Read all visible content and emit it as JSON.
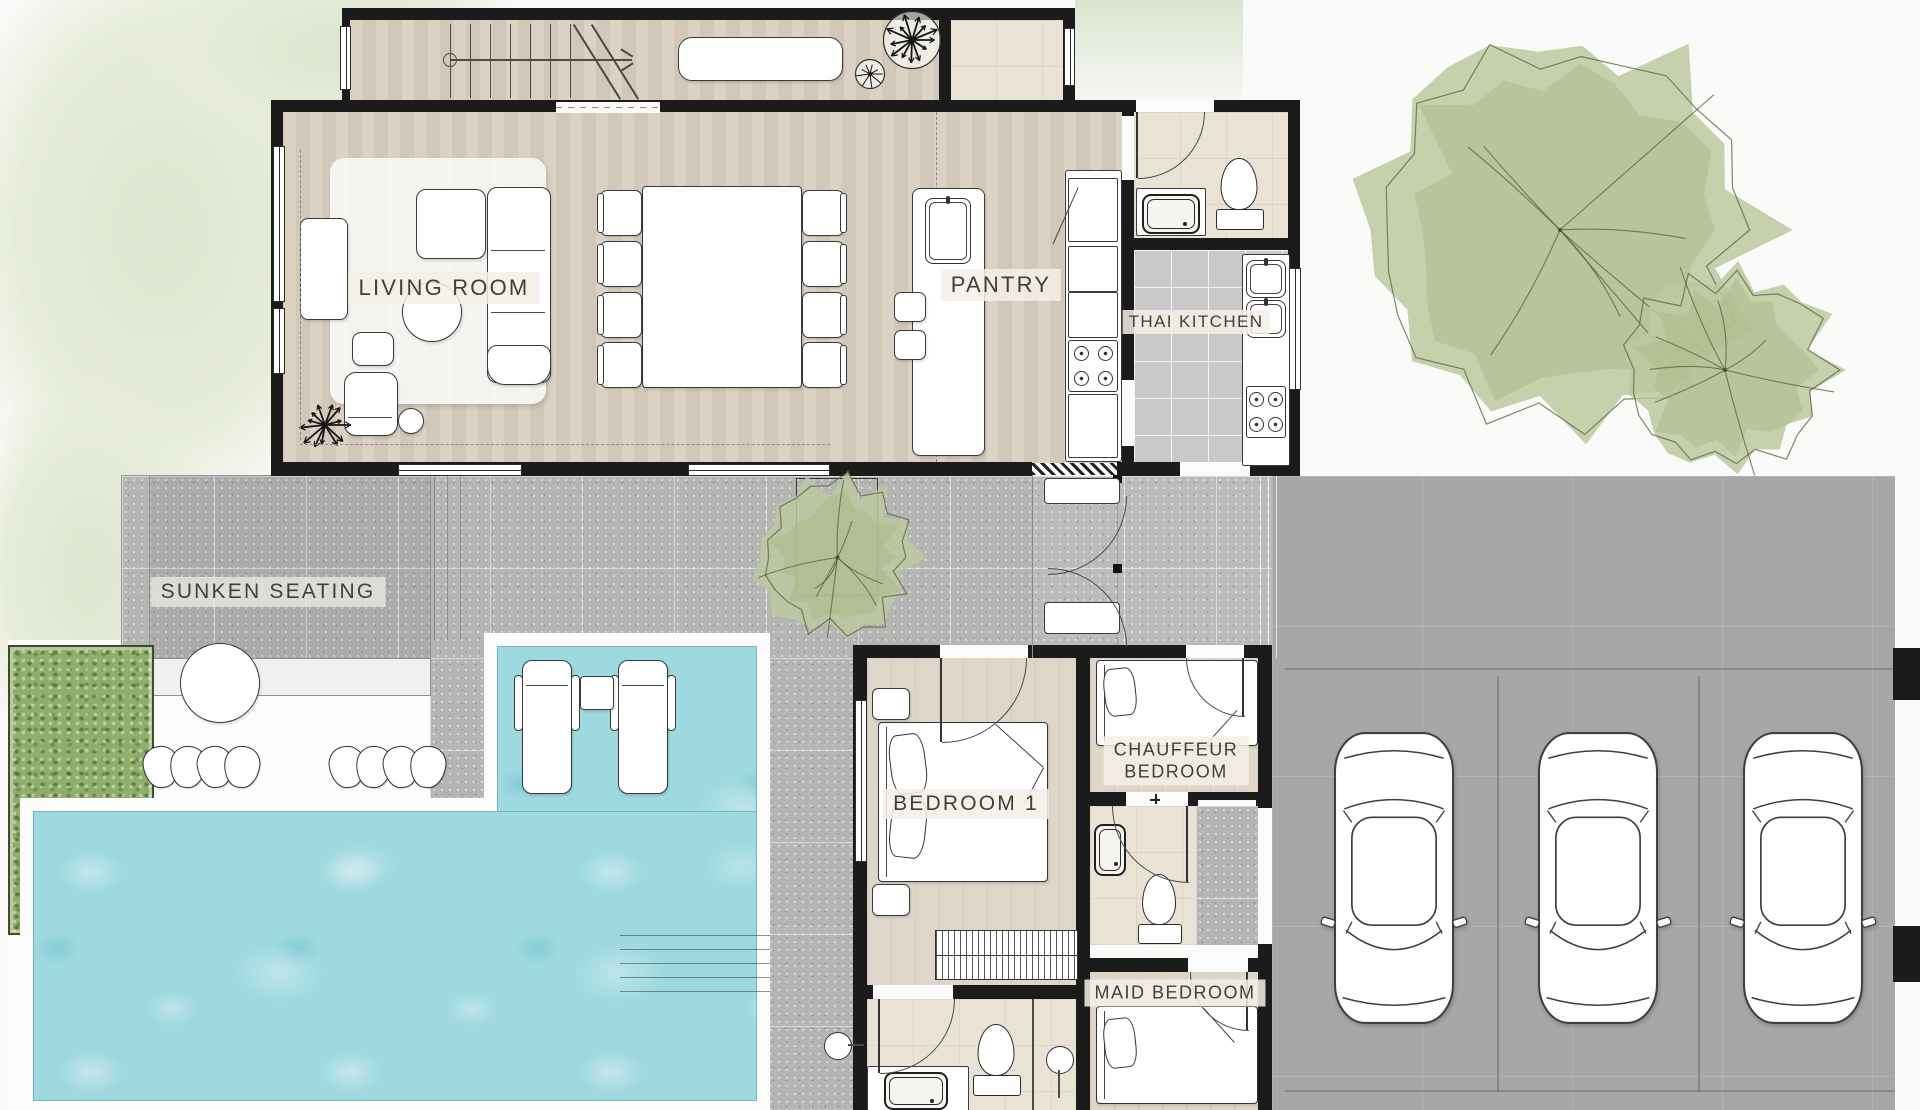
{
  "meta": {
    "type": "architectural floor plan",
    "view": "top-down villa ground floor with pool, garden and 3-car garage"
  },
  "rooms": {
    "living_room": "LIVING ROOM",
    "pantry": "PANTRY",
    "thai_kitchen": "THAI KITCHEN",
    "sunken_seating": "SUNKEN SEATING",
    "bedroom_1": "BEDROOM 1",
    "chauffeur_bedroom": [
      "CHAUFFEUR",
      "BEDROOM"
    ],
    "maid_bedroom": "MAID BEDROOM"
  },
  "palette": {
    "wall": "#1b1b1b",
    "wood_floor": "#d9cfc0",
    "beige_tile": "#e9e3d5",
    "gray_tile": "#c9c9c7",
    "terrace": "#b5b6b3",
    "driveway": "#a6a7a9",
    "pool_water": "#9fd9e0",
    "tree_foliage": "#bcc8a0",
    "hedge": "#8fae6c",
    "lawn_wash": "#dce5cf",
    "label_text": "#3f3f3f",
    "label_bg": "#f3eee4"
  },
  "features": {
    "cars_in_garage": 3,
    "sun_loungers": 2,
    "dining_chairs": 8,
    "bar_stools": 2,
    "bathrooms": 3,
    "beds": 3,
    "trees": 3,
    "stair_flight": 1
  }
}
